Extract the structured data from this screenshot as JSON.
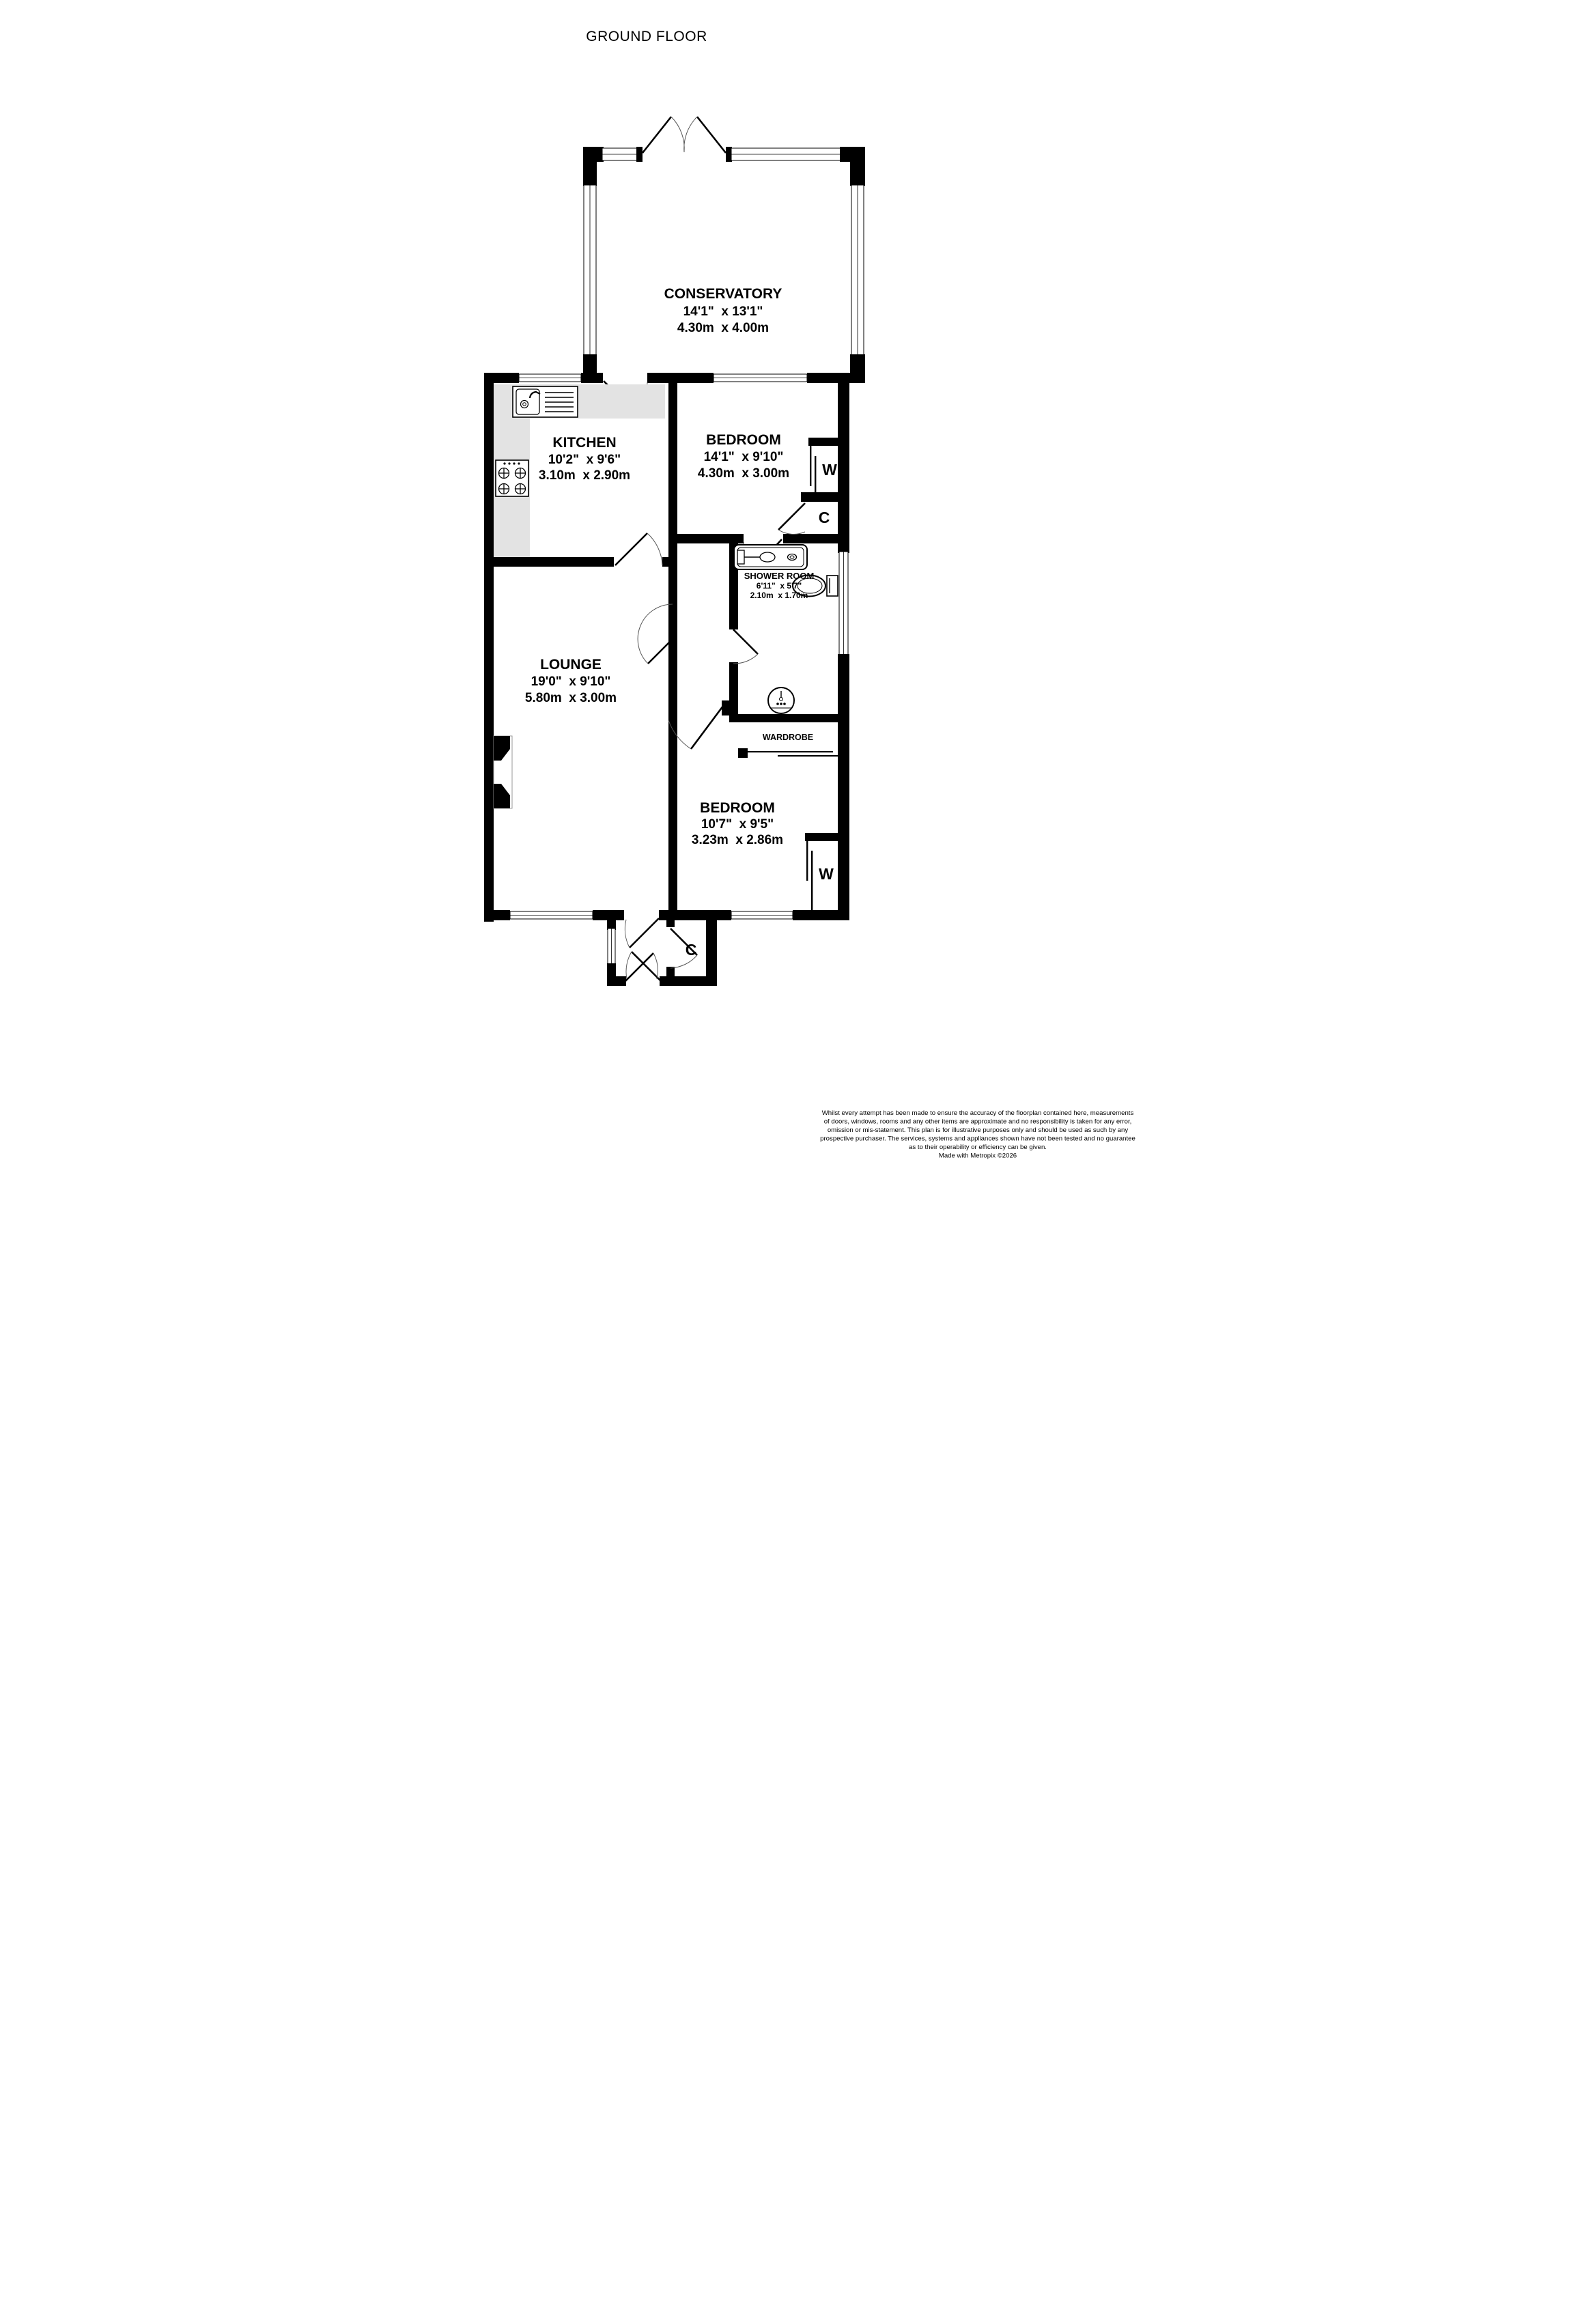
{
  "title": "GROUND FLOOR",
  "rooms": {
    "conservatory": {
      "name": "CONSERVATORY",
      "imperial": "14'1\"  x 13'1\"",
      "metric": "4.30m  x 4.00m"
    },
    "kitchen": {
      "name": "KITCHEN",
      "imperial": "10'2\"  x 9'6\"",
      "metric": "3.10m  x 2.90m"
    },
    "bedroom1": {
      "name": "BEDROOM",
      "imperial": "14'1\"  x 9'10\"",
      "metric": "4.30m  x 3.00m"
    },
    "shower": {
      "name": "SHOWER ROOM",
      "imperial": "6'11\"  x 5'7\"",
      "metric": "2.10m  x 1.70m"
    },
    "wardrobe_room": {
      "name": "WARDROBE"
    },
    "lounge": {
      "name": "LOUNGE",
      "imperial": "19'0\"  x 9'10\"",
      "metric": "5.80m  x 3.00m"
    },
    "bedroom2": {
      "name": "BEDROOM",
      "imperial": "10'7\"  x 9'5\"",
      "metric": "3.23m  x 2.86m"
    }
  },
  "labels": {
    "wardrobe1": "W",
    "cupboard1": "C",
    "wardrobe2": "W",
    "cupboard2": "C"
  },
  "colors": {
    "wall": "#000000",
    "counter": "#e3e3e3",
    "background": "#ffffff"
  },
  "footer": {
    "l1": "Whilst every attempt has been made to ensure the accuracy of the floorplan contained here, measurements",
    "l2": "of doors, windows, rooms and any other items are approximate and no responsibility is taken for any error,",
    "l3": "omission or mis-statement. This plan is for illustrative purposes only and should be used as such by any",
    "l4": "prospective purchaser. The services, systems and appliances shown have not been tested and no guarantee",
    "l5": "as to their operability or efficiency can be given.",
    "l6": "Made with Metropix ©2026"
  }
}
